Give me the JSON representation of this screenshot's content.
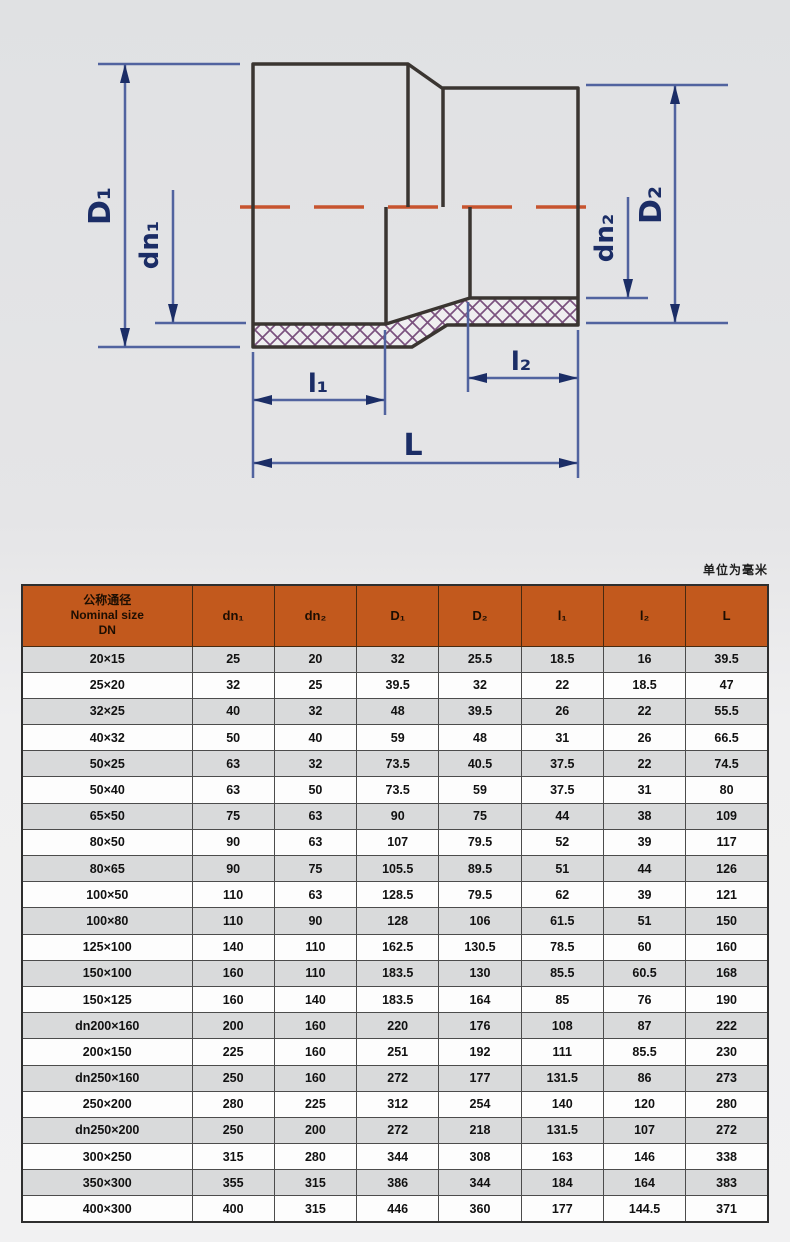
{
  "diagram": {
    "labels": {
      "D1": "D₁",
      "dn1": "dn₁",
      "D2": "D₂",
      "dn2": "dn₂",
      "l1": "l₁",
      "l2": "l₂",
      "L": "L"
    },
    "colors": {
      "dimension_line": "#51639f",
      "arrow_and_label": "#1b2d66",
      "outline": "#3a3531",
      "centerline": "#c7542f",
      "hatch": "#7b527f"
    }
  },
  "table": {
    "unit_note": "单位为毫米",
    "header": {
      "nominal": "公称通径\nNominal size\nDN",
      "cols": [
        "dn₁",
        "dn₂",
        "D₁",
        "D₂",
        "l₁",
        "l₂",
        "L"
      ]
    },
    "rows": [
      [
        "20×15",
        "25",
        "20",
        "32",
        "25.5",
        "18.5",
        "16",
        "39.5"
      ],
      [
        "25×20",
        "32",
        "25",
        "39.5",
        "32",
        "22",
        "18.5",
        "47"
      ],
      [
        "32×25",
        "40",
        "32",
        "48",
        "39.5",
        "26",
        "22",
        "55.5"
      ],
      [
        "40×32",
        "50",
        "40",
        "59",
        "48",
        "31",
        "26",
        "66.5"
      ],
      [
        "50×25",
        "63",
        "32",
        "73.5",
        "40.5",
        "37.5",
        "22",
        "74.5"
      ],
      [
        "50×40",
        "63",
        "50",
        "73.5",
        "59",
        "37.5",
        "31",
        "80"
      ],
      [
        "65×50",
        "75",
        "63",
        "90",
        "75",
        "44",
        "38",
        "109"
      ],
      [
        "80×50",
        "90",
        "63",
        "107",
        "79.5",
        "52",
        "39",
        "117"
      ],
      [
        "80×65",
        "90",
        "75",
        "105.5",
        "89.5",
        "51",
        "44",
        "126"
      ],
      [
        "100×50",
        "110",
        "63",
        "128.5",
        "79.5",
        "62",
        "39",
        "121"
      ],
      [
        "100×80",
        "110",
        "90",
        "128",
        "106",
        "61.5",
        "51",
        "150"
      ],
      [
        "125×100",
        "140",
        "110",
        "162.5",
        "130.5",
        "78.5",
        "60",
        "160"
      ],
      [
        "150×100",
        "160",
        "110",
        "183.5",
        "130",
        "85.5",
        "60.5",
        "168"
      ],
      [
        "150×125",
        "160",
        "140",
        "183.5",
        "164",
        "85",
        "76",
        "190"
      ],
      [
        "dn200×160",
        "200",
        "160",
        "220",
        "176",
        "108",
        "87",
        "222"
      ],
      [
        "200×150",
        "225",
        "160",
        "251",
        "192",
        "111",
        "85.5",
        "230"
      ],
      [
        "dn250×160",
        "250",
        "160",
        "272",
        "177",
        "131.5",
        "86",
        "273"
      ],
      [
        "250×200",
        "280",
        "225",
        "312",
        "254",
        "140",
        "120",
        "280"
      ],
      [
        "dn250×200",
        "250",
        "200",
        "272",
        "218",
        "131.5",
        "107",
        "272"
      ],
      [
        "300×250",
        "315",
        "280",
        "344",
        "308",
        "163",
        "146",
        "338"
      ],
      [
        "350×300",
        "355",
        "315",
        "386",
        "344",
        "184",
        "164",
        "383"
      ],
      [
        "400×300",
        "400",
        "315",
        "446",
        "360",
        "177",
        "144.5",
        "371"
      ]
    ]
  }
}
